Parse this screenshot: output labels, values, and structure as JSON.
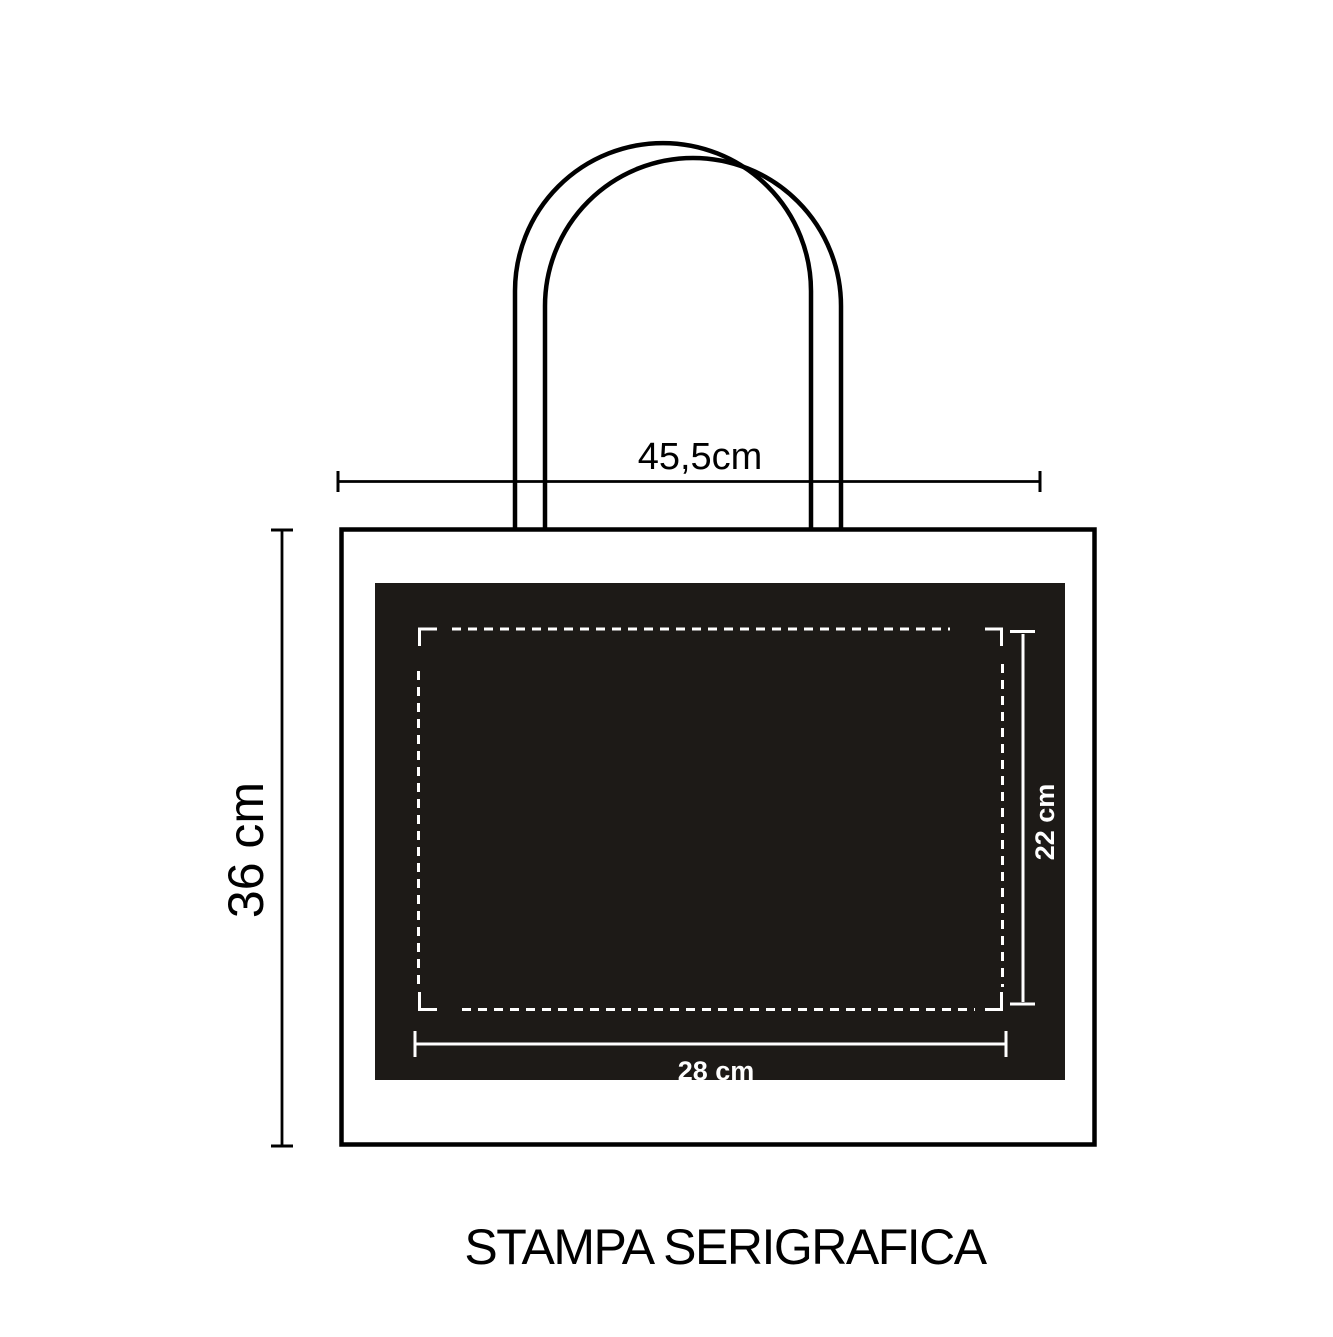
{
  "title": "STAMPA SERIGRAFICA",
  "bag": {
    "width_label": "45,5cm",
    "height_label": "36 cm"
  },
  "print_area": {
    "width_label": "28 cm",
    "height_label": "22 cm"
  },
  "colors": {
    "background": "#ffffff",
    "outline": "#000000",
    "print_panel": "#1d1a17",
    "print_marks": "#ffffff"
  }
}
